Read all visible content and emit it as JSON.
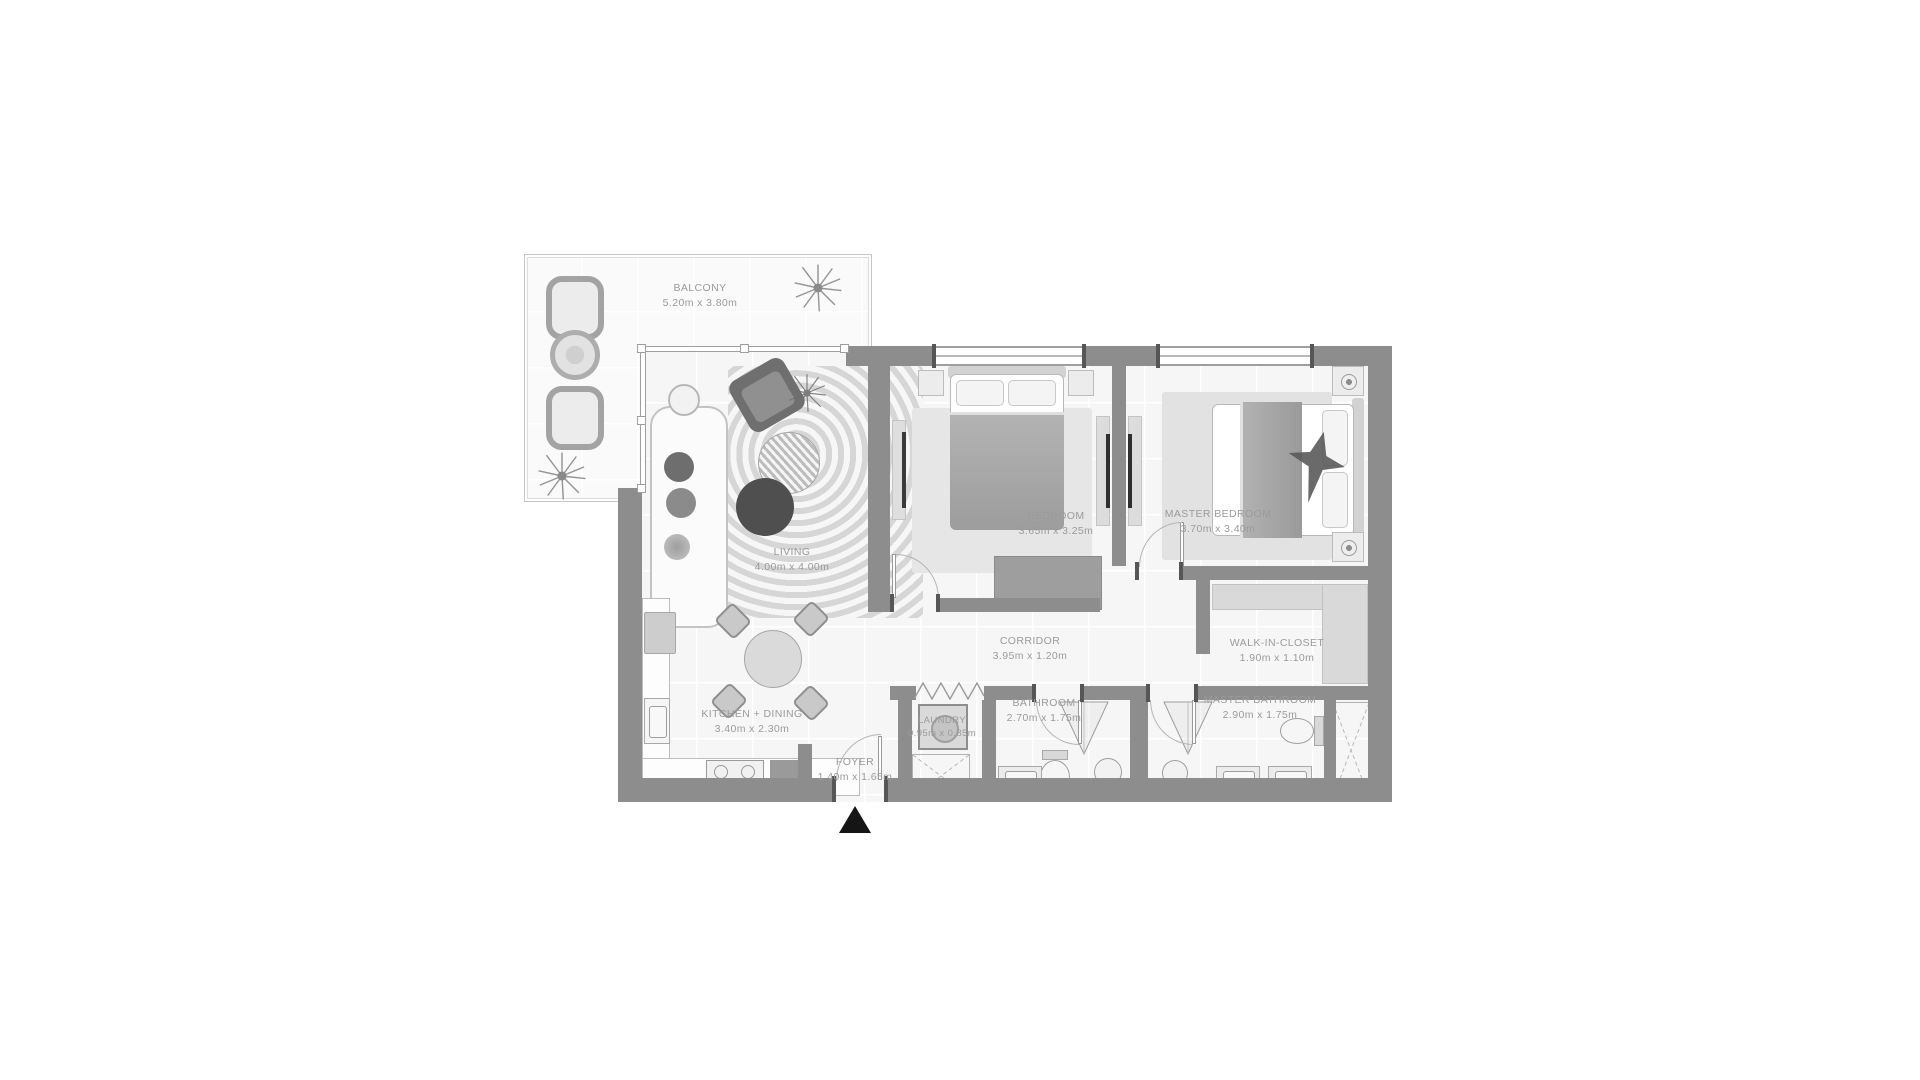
{
  "plan": {
    "rooms": {
      "balcony": {
        "label": "BALCONY",
        "dims": "5.20m x 3.80m"
      },
      "living": {
        "label": "LIVING",
        "dims": "4.00m x 4.00m"
      },
      "bedroom": {
        "label": "BEDROOM",
        "dims": "3.65m x 3.25m"
      },
      "master_bedroom": {
        "label": "MASTER BEDROOM",
        "dims": "3.70m x 3.40m"
      },
      "corridor": {
        "label": "CORRIDOR",
        "dims": "3.95m x 1.20m"
      },
      "walk_in_closet": {
        "label": "WALK-IN-CLOSET",
        "dims": "1.90m x 1.10m"
      },
      "kitchen_dining": {
        "label": "KITCHEN + DINING",
        "dims": "3.40m x 2.30m"
      },
      "laundry": {
        "label": "LAUNDRY",
        "dims": "0.95m x 0.85m"
      },
      "bathroom": {
        "label": "BATHROOM",
        "dims": "2.70m x 1.75m"
      },
      "master_bathroom": {
        "label": "MASTER BATHROOM",
        "dims": "2.90m x 1.75m"
      },
      "foyer": {
        "label": "FOYER",
        "dims": "1.40m x 1.65m"
      }
    },
    "entrance": {
      "marker": "up-triangle",
      "color": "#151515"
    },
    "colors": {
      "wall": "#8d8d8d",
      "floor": "#f6f6f6",
      "grid_line": "#ffffff",
      "label_text": "#9b9b9b",
      "furniture_dark": "#4f4f4f",
      "outline": "#b8b8b8"
    }
  }
}
